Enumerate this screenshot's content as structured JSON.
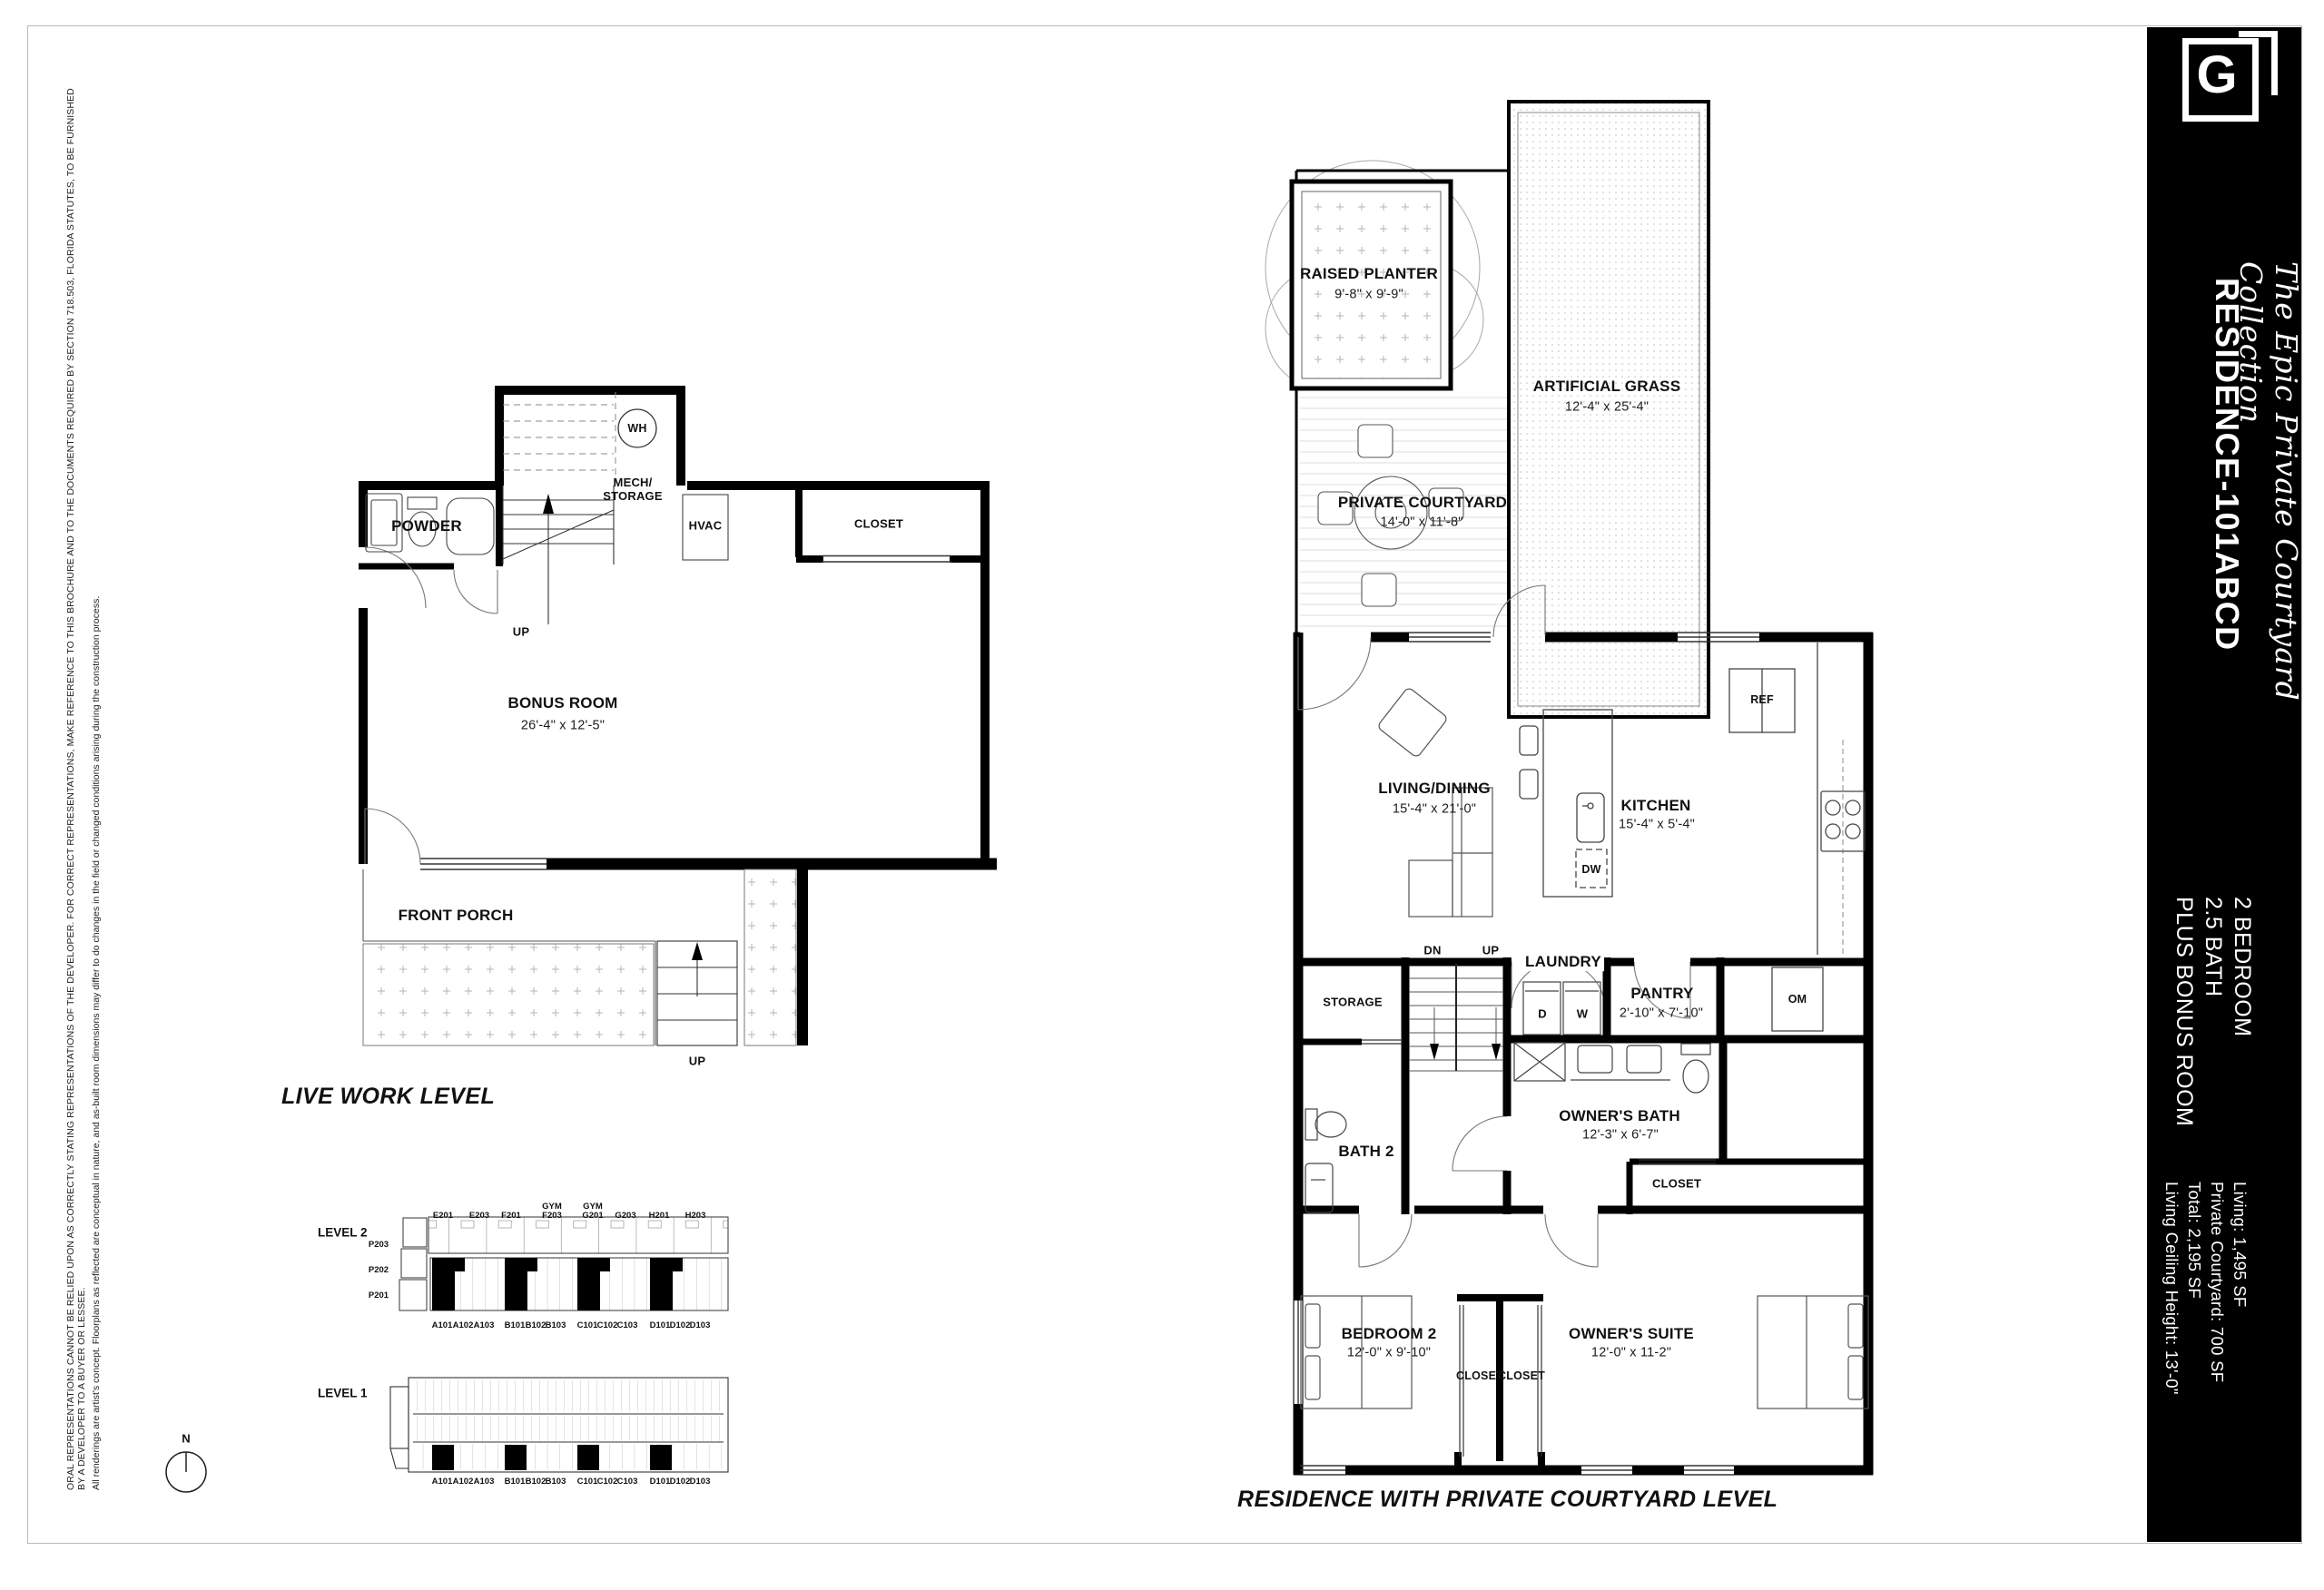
{
  "disclaimer": {
    "line1": "ORAL REPRESENTATIONS CANNOT BE RELIED UPON AS CORRECTLY STATING REPRESENTATIONS OF THE DEVELOPER. FOR CORRECT REPRESENTATIONS, MAKE REFERENCE TO THIS BROCHURE AND TO THE DOCUMENTS REQUIRED BY SECTION 718.503, FLORIDA STATUTES, TO BE FURNISHED BY A DEVELOPER TO A BUYER OR LESSEE.",
    "line2": "All renderings are artist's concept.  Floorplans as reflected are conceptual in nature, and as-built room dimensions may differ to do changes in the field or changed conditions arising during the construction process."
  },
  "live_work": {
    "title": "LIVE WORK LEVEL",
    "powder": "POWDER",
    "mech_storage": "MECH/\nSTORAGE",
    "wh": "WH",
    "hvac": "HVAC",
    "closet": "CLOSET",
    "bonus_room": "BONUS ROOM",
    "bonus_room_dim": "26'-4\" x 12'-5\"",
    "front_porch": "FRONT PORCH",
    "stair_up": "UP",
    "entry_up": "UP"
  },
  "key_plan": {
    "level2_label": "LEVEL 2",
    "level1_label": "LEVEL 1",
    "compass_n": "N",
    "top_units": [
      "E201",
      "E203",
      "F201",
      "GYM\nF203",
      "GYM\nG201",
      "G203",
      "H201",
      "H203"
    ],
    "p_units": [
      "P203",
      "P202",
      "P201"
    ],
    "bottom_units": [
      "A101",
      "A102",
      "A103",
      "B101",
      "B102",
      "B103",
      "C101",
      "C102",
      "C103",
      "D101",
      "D102",
      "D103"
    ]
  },
  "courtyard_level": {
    "title": "RESIDENCE WITH PRIVATE COURTYARD LEVEL",
    "raised_planter": "RAISED PLANTER",
    "raised_planter_dim": "9'-8\" x 9'-9\"",
    "artificial_grass": "ARTIFICIAL GRASS",
    "artificial_grass_dim": "12'-4\" x 25'-4\"",
    "private_courtyard": "PRIVATE COURTYARD",
    "private_courtyard_dim": "14'-0\" x 11'-8\"",
    "ref": "REF",
    "living_dining": "LIVING/DINING",
    "living_dining_dim": "15'-4\" x 21'-0\"",
    "kitchen": "KITCHEN",
    "kitchen_dim": "15'-4\" x 5'-4\"",
    "dw": "DW",
    "om": "OM",
    "dn": "DN",
    "up": "UP",
    "laundry": "LAUNDRY",
    "dryer": "D",
    "washer": "W",
    "pantry": "PANTRY",
    "pantry_dim": "2'-10\" x 7'-10\"",
    "storage": "STORAGE",
    "bath2": "BATH 2",
    "owners_bath": "OWNER'S BATH",
    "owners_bath_dim": "12'-3\" x 6'-7\"",
    "owners_closet": "CLOSET",
    "bedroom2": "BEDROOM 2",
    "bedroom2_dim": "12'-0\" x 9'-10\"",
    "owners_suite": "OWNER'S SUITE",
    "owners_suite_dim": "12'-0\" x 11-2\"",
    "closet_left": "CLOSET",
    "closet_right": "CLOSET"
  },
  "sidebar": {
    "logo_letter": "G",
    "collection": "The Epic Private Courtyard Collection",
    "residence": "RESIDENCE-101ABCD",
    "features": [
      "2 BEDROOM",
      "2.5 BATH",
      "PLUS BONUS ROOM"
    ],
    "stats": [
      "Living: 1,495 SF",
      "Private Courtyard: 700 SF",
      "Total: 2,195 SF",
      "Living Ceiling Height:  13'-0\""
    ]
  }
}
